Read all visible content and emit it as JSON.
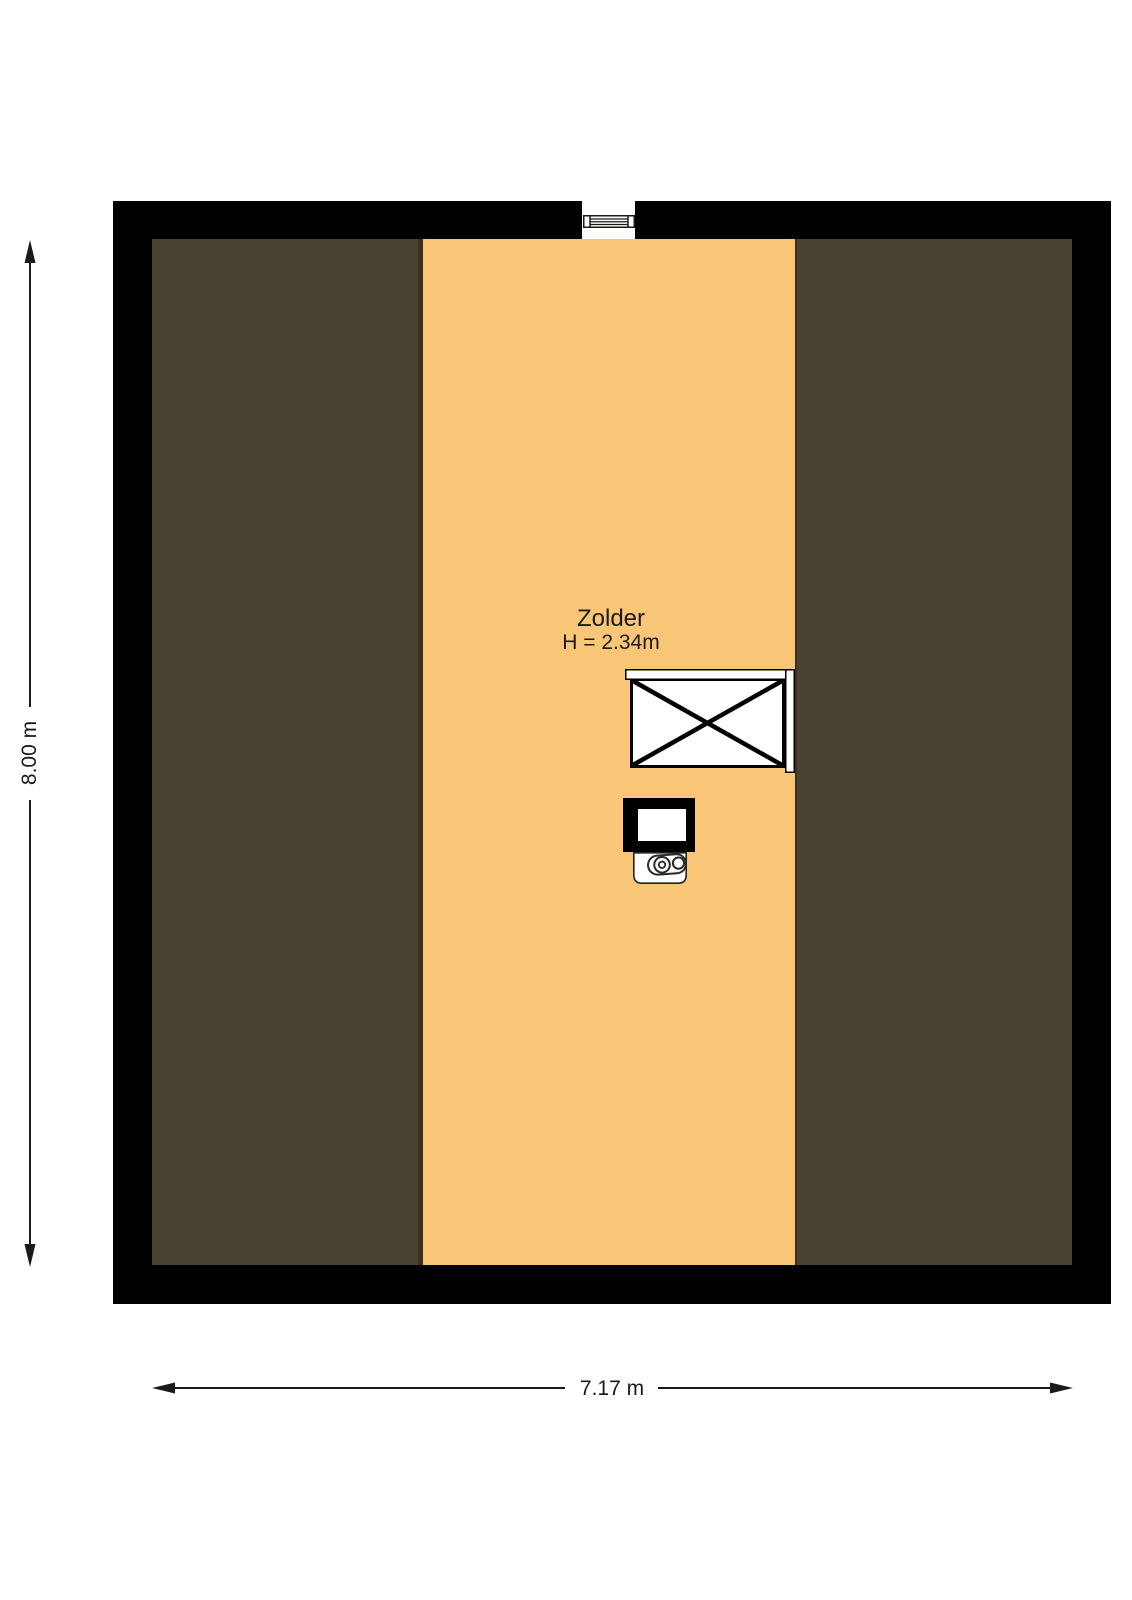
{
  "floorplan": {
    "room": {
      "name": "Zolder",
      "height_label": "H = 2.34m"
    },
    "dimensions": {
      "vertical": "8.00 m",
      "horizontal": "7.17 m"
    },
    "colors": {
      "wall": "#000000",
      "floor": "#f9c678",
      "slope": "#4a4232",
      "slope-edge": "#3a3124",
      "background": "#ffffff",
      "line": "#1a1a1a"
    },
    "icons": [
      {
        "name": "window-icon",
        "meaning": "window opening in top wall"
      },
      {
        "name": "stairs-icon",
        "meaning": "staircase opening marked with X"
      },
      {
        "name": "boiler-icon",
        "meaning": "heating boiler unit"
      }
    ]
  }
}
